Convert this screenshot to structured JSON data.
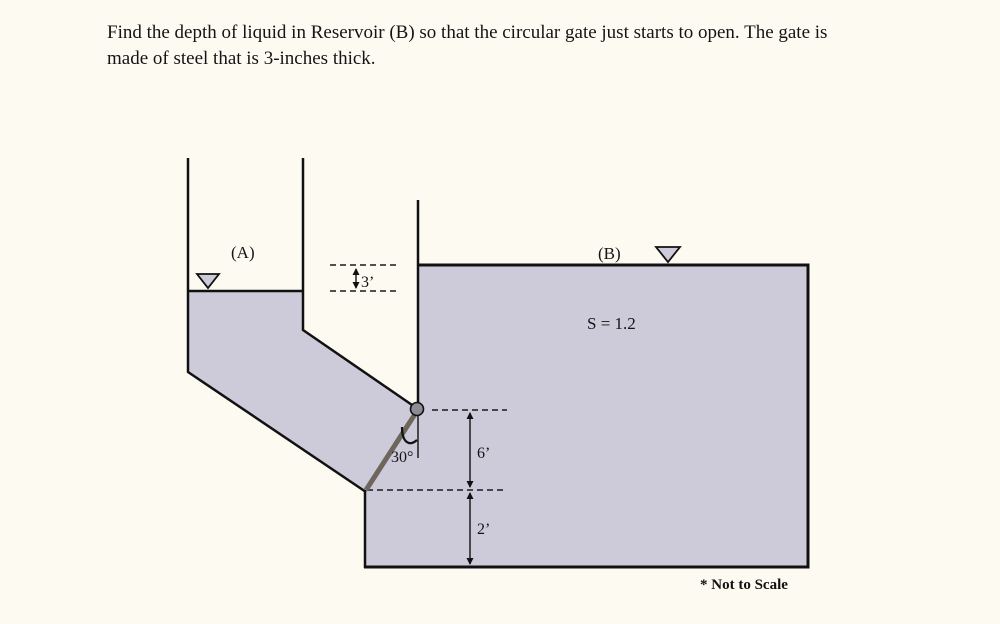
{
  "problem": {
    "line1": "Find the depth of liquid in Reservoir (B) so that the circular gate just starts to open. The gate is",
    "line2": "made of steel that is 3-inches thick."
  },
  "diagram": {
    "labels": {
      "reservoir_a": "(A)",
      "reservoir_b": "(B)",
      "specific_gravity": "S = 1.2",
      "head_difference": "3’",
      "gate_span": "6’",
      "bottom_offset": "2’",
      "gate_angle": "30°",
      "note": "* Not to Scale"
    },
    "colors": {
      "background": "#fdfaf2",
      "liquid": "#cdcad9",
      "line": "#111111",
      "gate": "#6e665c",
      "hinge": "#8e8a96"
    }
  }
}
